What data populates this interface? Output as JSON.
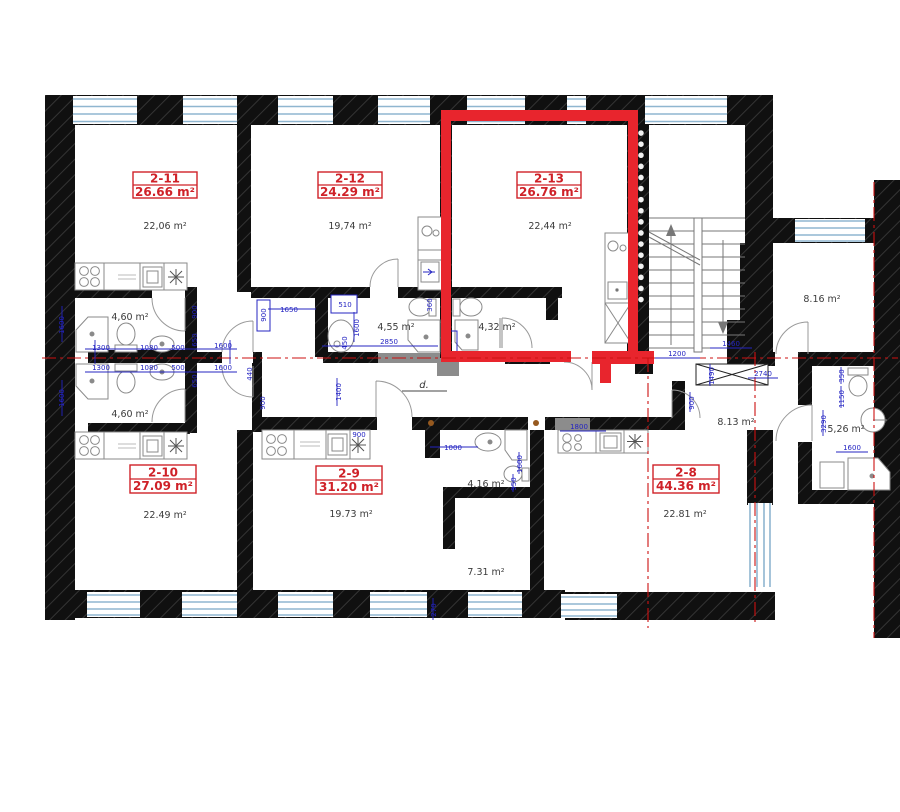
{
  "drawing": {
    "kind": "architectural floor plan",
    "corridor_label": "d.",
    "highlighted_unit": "2-13"
  },
  "colors": {
    "wall": "#101010",
    "highlight_red": "#e8252d",
    "centerline_red": "#cc1111",
    "dimension_blue": "#2424c2",
    "label_red": "#cf2128",
    "window_blue": "#8fb6d0",
    "fixture_gray": "#8a8a8a"
  },
  "apartments": [
    {
      "unit": "2-11",
      "area": "26.66 m²"
    },
    {
      "unit": "2-12",
      "area": "24.29 m²"
    },
    {
      "unit": "2-13",
      "area": "26.76 m²"
    },
    {
      "unit": "2-10",
      "area": "27.09 m²"
    },
    {
      "unit": "2-9",
      "area": "31.20 m²"
    },
    {
      "unit": "2-8",
      "area": "44.36 m²"
    }
  ],
  "room_areas": [
    "22,06 m²",
    "19,74 m²",
    "22,44 m²",
    "4,60 m²",
    "4,55 m²",
    "4,32 m²",
    "8.16 m²",
    "4,60 m²",
    "8.13 m²",
    "5,26 m²",
    "22.49 m²",
    "19.73 m²",
    "4.16 m²",
    "7.31 m²",
    "22.81 m²"
  ],
  "dimensions": [
    "1600",
    "1300",
    "1080",
    "500",
    "900",
    "650",
    "1600",
    "1650",
    "900",
    "510",
    "1600",
    "360",
    "2850",
    "1600",
    "1300",
    "1080",
    "500",
    "650",
    "1600",
    "440",
    "900",
    "1400",
    "900",
    "1000",
    "1600",
    "950",
    "1800",
    "1460",
    "1200",
    "1490",
    "2740",
    "900",
    "350",
    "1150",
    "3290",
    "1600",
    "270",
    "450"
  ]
}
